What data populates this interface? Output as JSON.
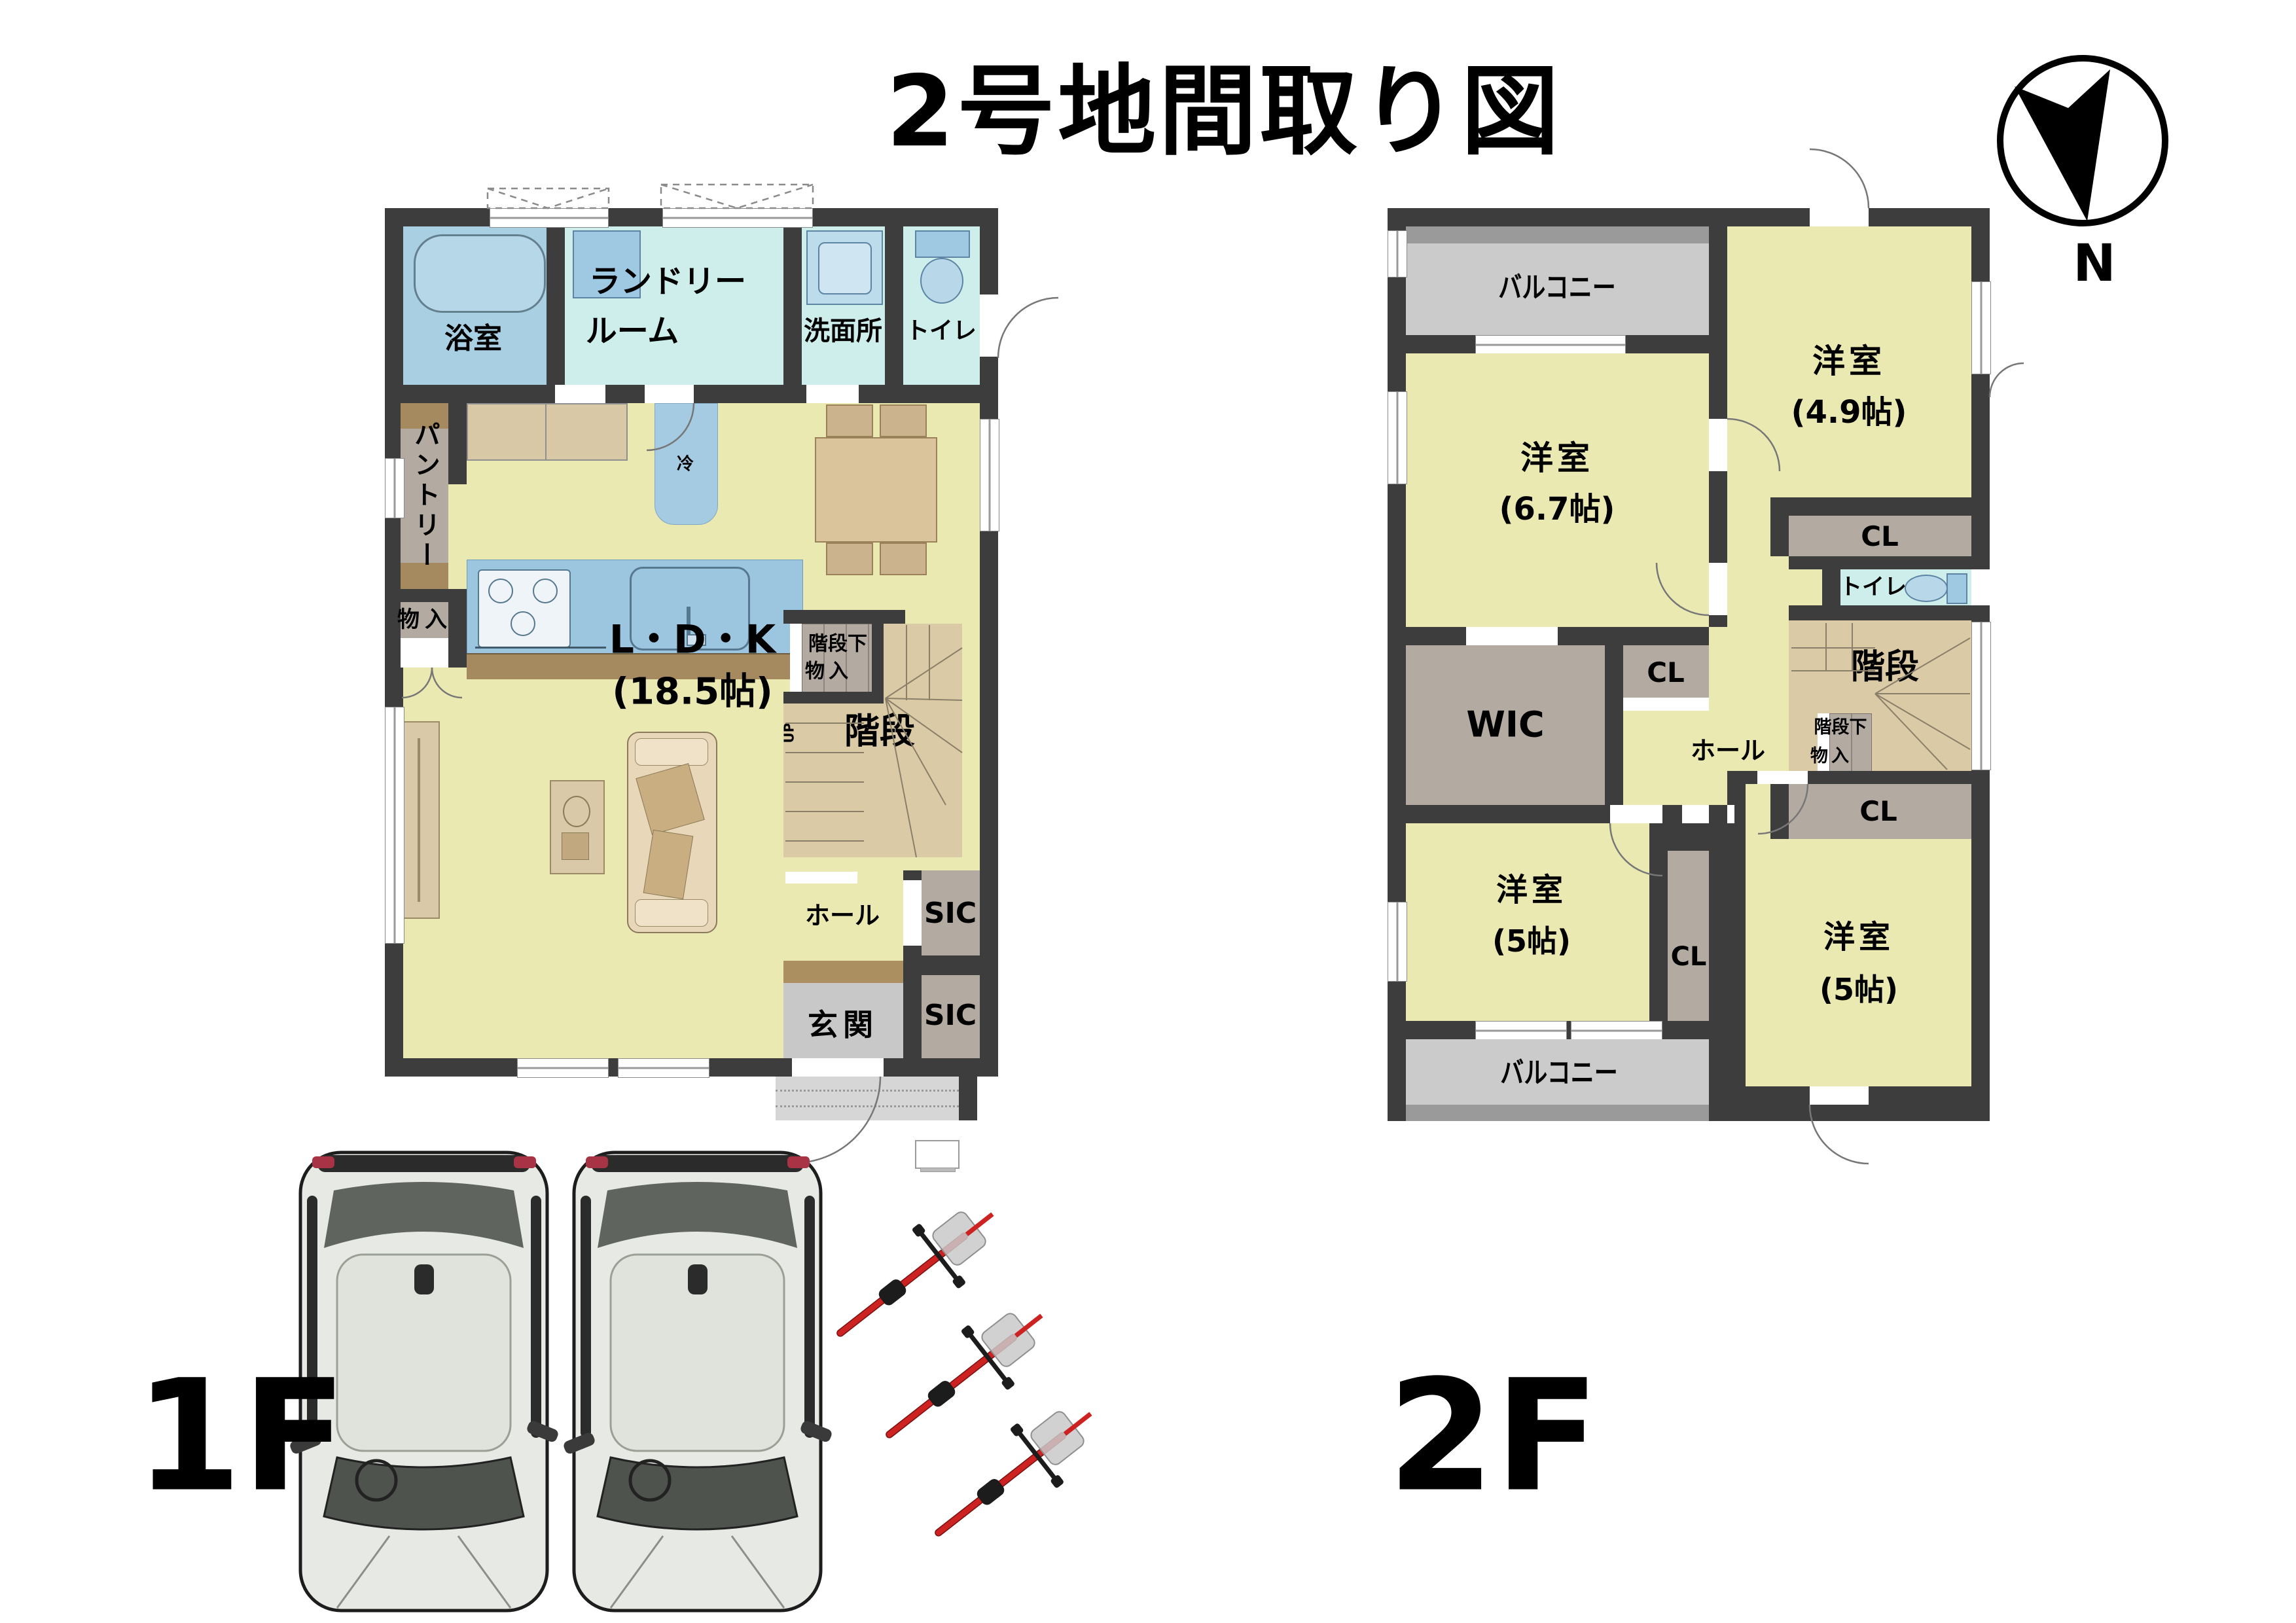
{
  "title": "2号地間取り図",
  "compass": {
    "north": "N"
  },
  "floor_labels": {
    "f1": "1F",
    "f2": "2F"
  },
  "f1": {
    "bath": "浴室",
    "laundry1": "ランドリー",
    "laundry2": "ルーム",
    "washroom": "洗面所",
    "toilet": "トイレ",
    "pantry": "パントリー",
    "storage": "物入",
    "fridge": "冷",
    "ldk1": "L・D・K",
    "ldk2": "(18.5帖)",
    "understairs1": "階段下",
    "understairs2": "物入",
    "stairs": "階段",
    "up": "UP",
    "hall": "ホール",
    "sic_upper": "SIC",
    "sic_lower": "SIC",
    "entrance": "玄関"
  },
  "f2": {
    "balcony_top": "バルコニー",
    "balcony_bottom": "バルコニー",
    "room67_1": "洋室",
    "room67_2": "(6.7帖)",
    "room49_1": "洋室",
    "room49_2": "(4.9帖)",
    "room5l_1": "洋室",
    "room5l_2": "(5帖)",
    "room5r_1": "洋室",
    "room5r_2": "(5帖)",
    "cl_top": "CL",
    "cl_mid": "CL",
    "cl_right": "CL",
    "cl_bottom": "CL",
    "toilet": "トイレ",
    "wic": "WIC",
    "hall": "ホール",
    "stairs": "階段",
    "understairs1": "階段下",
    "understairs2": "物入"
  },
  "colors": {
    "wall": "#3e3d3d",
    "yellow": "#ebe9b2",
    "cyan": "#cdeeea",
    "bathblue": "#a9cfe2",
    "taupe": "#b3aaa2",
    "brown": "#a5895f",
    "tan": "#dbcaa6",
    "balc": "#cbcbcb",
    "balcedge": "#9a9a9a",
    "genkan": "#c8c8c8",
    "porch": "#d6d6d6",
    "fixture": "#9fc9e3",
    "furn": "#d9c49c",
    "island": "#9cc6e0",
    "counter": "#d9c8a6",
    "bike": "#cc2222"
  }
}
